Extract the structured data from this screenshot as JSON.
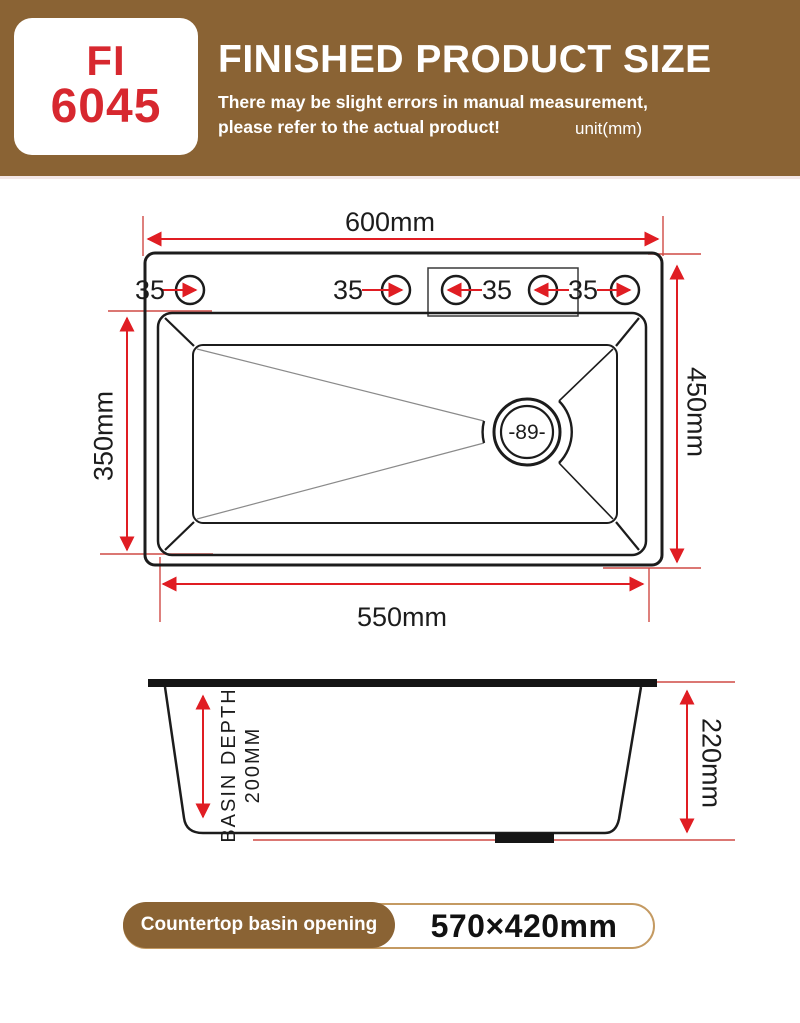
{
  "header": {
    "model_line1": "FI",
    "model_line2": "6045",
    "title": "FINISHED PRODUCT SIZE",
    "subtitle_line1": "There may be slight errors in manual measurement,",
    "subtitle_line2": "please refer to the actual product!",
    "unit_note": "unit(mm)"
  },
  "top_view": {
    "overall_width": "600mm",
    "overall_depth": "450mm",
    "basin_length": "550mm",
    "basin_width": "350mm",
    "faucet_hole_labels": [
      "35",
      "35",
      "35",
      "35"
    ],
    "drain_diameter": "-89-"
  },
  "side_view": {
    "depth_label_line1": "BASIN DEPTH",
    "depth_label_line2": "200MM",
    "overall_height": "220mm"
  },
  "footer": {
    "label": "Countertop basin opening",
    "value": "570×420mm"
  },
  "colors": {
    "banner_brown": "#8a6334",
    "model_red": "#d7282f",
    "dimension_red": "#e01d23",
    "extension_red": "#cf4a45",
    "line_black": "#1c1c1c",
    "footer_border_tan": "#c49a62"
  }
}
